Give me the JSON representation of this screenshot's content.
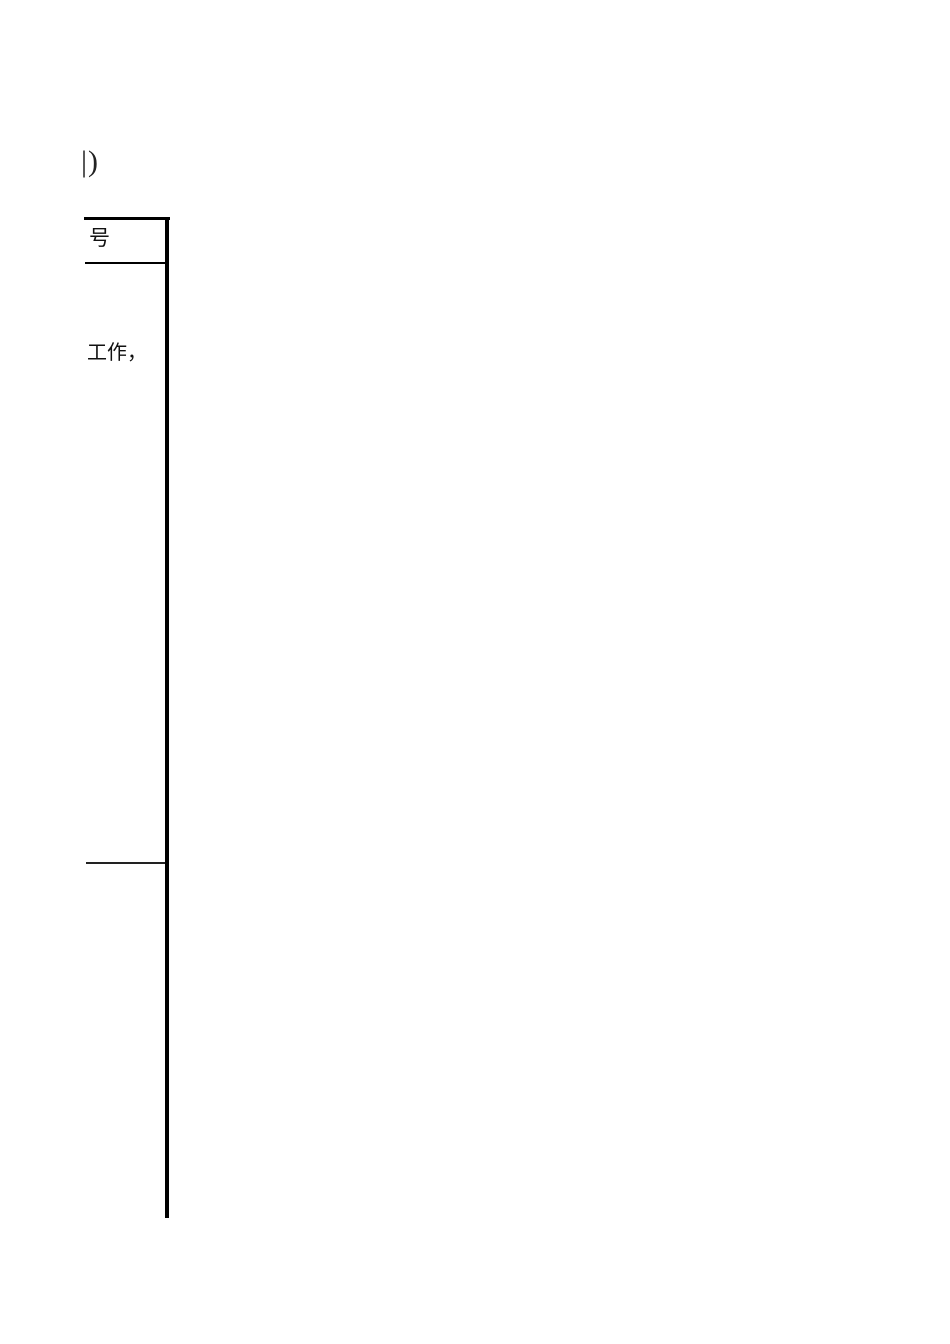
{
  "page": {
    "cropped_text": "|)",
    "table_fragment": {
      "header_cell_text": "号",
      "body_cell_text": "工作，"
    },
    "colors": {
      "background": "#ffffff",
      "border": "#000000",
      "text": "#111111"
    }
  }
}
